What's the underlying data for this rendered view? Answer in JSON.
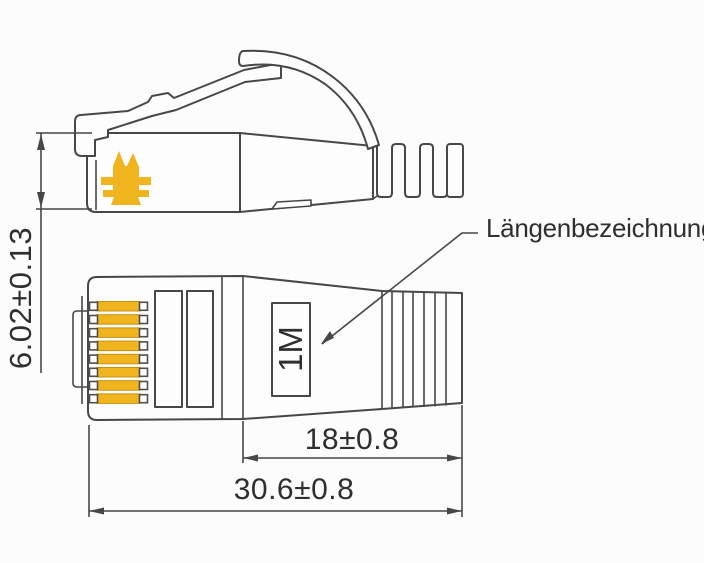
{
  "drawing": {
    "type": "technical-drawing",
    "subject": "RJ45 plug with strain relief boot, side view and bottom view",
    "views": [
      "side-view",
      "bottom-view"
    ],
    "annotation_label": "Längenbezeichnung",
    "length_marking": "1M",
    "pin_count": 8,
    "dimensions": {
      "plug_height": "6.02±0.13",
      "boot_length": "18±0.8",
      "total_length": "30.6±0.8"
    }
  },
  "icons": [
    {
      "name": "latch-arrows-icon",
      "description": "yellow double-arrow brand mark on plug body",
      "color": "#f0b51e"
    }
  ],
  "colors": {
    "line": "#474747",
    "text": "#2f2f2f",
    "gold": "#f0b51e",
    "gold_dark": "#c8920a",
    "background": "#fcfcfc"
  }
}
